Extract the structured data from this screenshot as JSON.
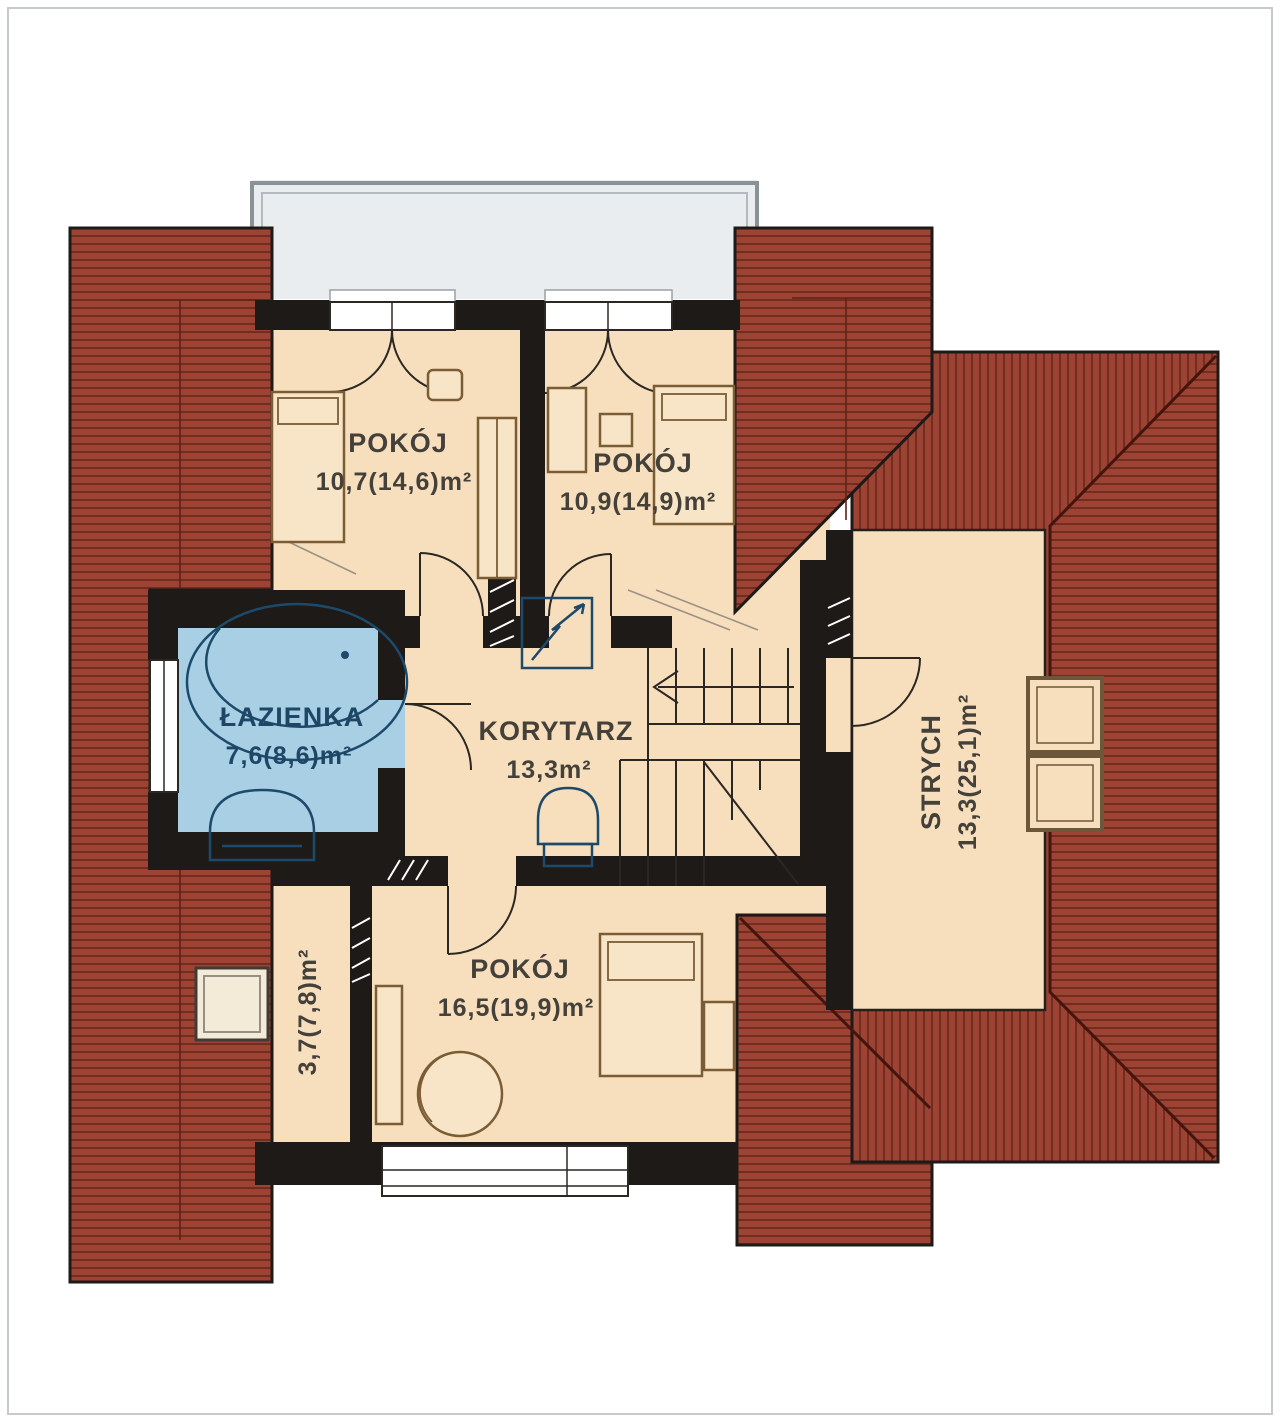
{
  "plan": {
    "type": "floor-plan",
    "rooms": {
      "room1": {
        "name": "POKÓJ",
        "area": "10,7(14,6)m²"
      },
      "room2": {
        "name": "POKÓJ",
        "area": "10,9(14,9)m²"
      },
      "bathroom": {
        "name": "ŁAZIENKA",
        "area": "7,6(8,6)m²"
      },
      "corridor": {
        "name": "KORYTARZ",
        "area": "13,3m²"
      },
      "attic": {
        "name": "STRYCH",
        "area": "13,3(25,1)m²"
      },
      "closet": {
        "area": "3,7(7,8)m²"
      },
      "room3": {
        "name": "POKÓJ",
        "area": "16,5(19,9)m²"
      }
    },
    "colors": {
      "roof": "#9c4334",
      "roof_hatch_line": "#6b281d",
      "floor": "#f7dfbd",
      "bathroom_floor": "#a9cfe5",
      "balcony": "#e9edef",
      "wall": "#1d1a17",
      "fixtures": "#1d4a6b",
      "furniture": "#7a5c35",
      "label_text": "#44403a",
      "bathroom_label_text": "#1e4766"
    }
  }
}
